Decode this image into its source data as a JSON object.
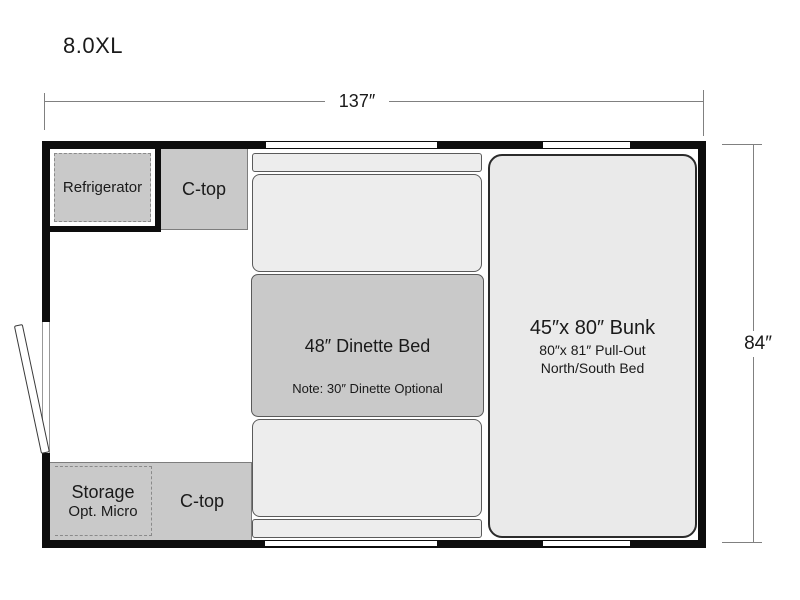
{
  "title": "8.0XL",
  "dimensions": {
    "width": "137″",
    "height": "84″"
  },
  "rooms": {
    "refrigerator": "Refrigerator",
    "ctop_upper": "C-top",
    "ctop_lower": "C-top",
    "dinette_title": "48″ Dinette Bed",
    "dinette_note": "Note: 30″ Dinette Optional",
    "bunk_title": "45″x 80″ Bunk",
    "bunk_sub1": "80″x 81″ Pull-Out",
    "bunk_sub2": "North/South Bed",
    "storage_title": "Storage",
    "storage_sub": "Opt. Micro"
  },
  "colors": {
    "wall": "#0d0d0d",
    "counter": "#c9c9c9",
    "cushion": "#ededed",
    "bunk": "#eaeaea",
    "line": "#808080",
    "ink": "#1a1a1a",
    "dash": "#8a8a8a",
    "edge": "#5a5a5a"
  }
}
